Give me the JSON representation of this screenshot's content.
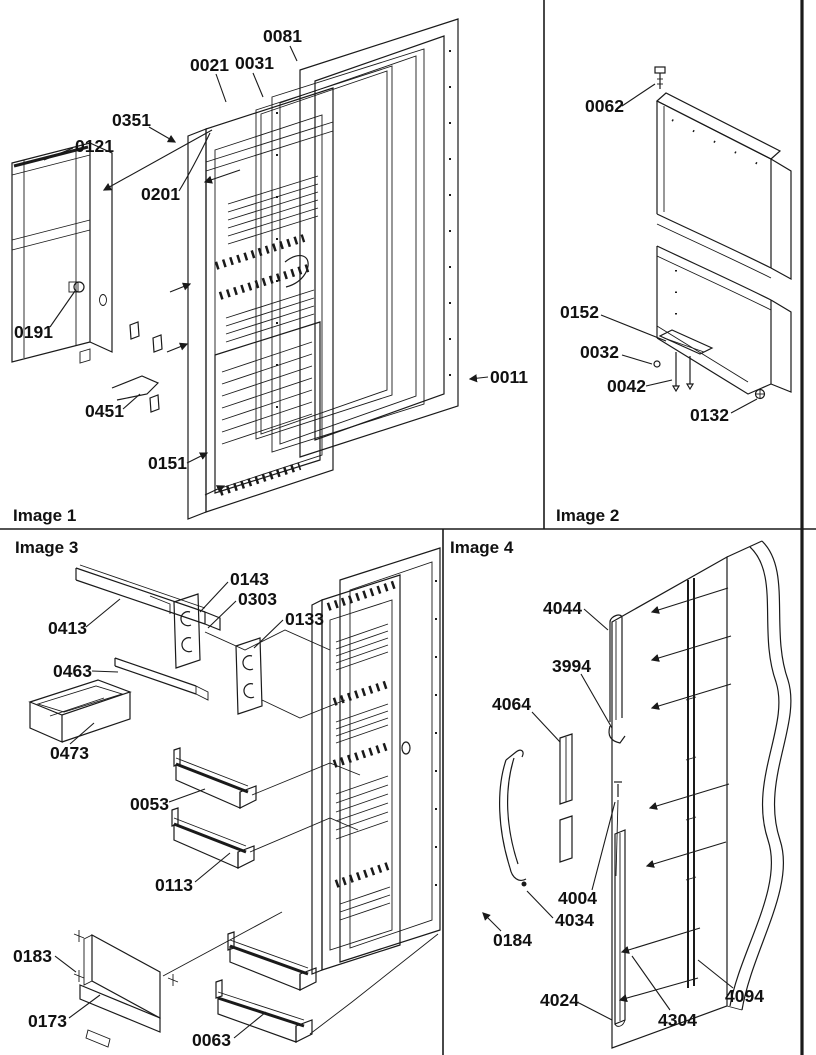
{
  "page": {
    "background_color": "#ffffff",
    "line_color": "#1a1a1a",
    "description": "Exploded-view appliance parts diagram in four quadrants"
  },
  "sections": {
    "image1": {
      "title": "Image 1",
      "labels": [
        {
          "text": "0081"
        },
        {
          "text": "0021"
        },
        {
          "text": "0031"
        },
        {
          "text": "0351"
        },
        {
          "text": "0121"
        },
        {
          "text": "0201"
        },
        {
          "text": "0191"
        },
        {
          "text": "0451"
        },
        {
          "text": "0151"
        },
        {
          "text": "0011"
        }
      ]
    },
    "image2": {
      "title": "Image 2",
      "labels": [
        {
          "text": "0062"
        },
        {
          "text": "0152"
        },
        {
          "text": "0032"
        },
        {
          "text": "0042"
        },
        {
          "text": "0132"
        }
      ]
    },
    "image3": {
      "title": "Image 3",
      "labels": [
        {
          "text": "0413"
        },
        {
          "text": "0143"
        },
        {
          "text": "0303"
        },
        {
          "text": "0133"
        },
        {
          "text": "0463"
        },
        {
          "text": "0473"
        },
        {
          "text": "0053"
        },
        {
          "text": "0113"
        },
        {
          "text": "0183"
        },
        {
          "text": "0173"
        },
        {
          "text": "0063"
        }
      ]
    },
    "image4": {
      "title": "Image 4",
      "labels": [
        {
          "text": "4044"
        },
        {
          "text": "3994"
        },
        {
          "text": "4064"
        },
        {
          "text": "4004"
        },
        {
          "text": "4034"
        },
        {
          "text": "0184"
        },
        {
          "text": "4024"
        },
        {
          "text": "4304"
        },
        {
          "text": "4094"
        }
      ]
    }
  }
}
